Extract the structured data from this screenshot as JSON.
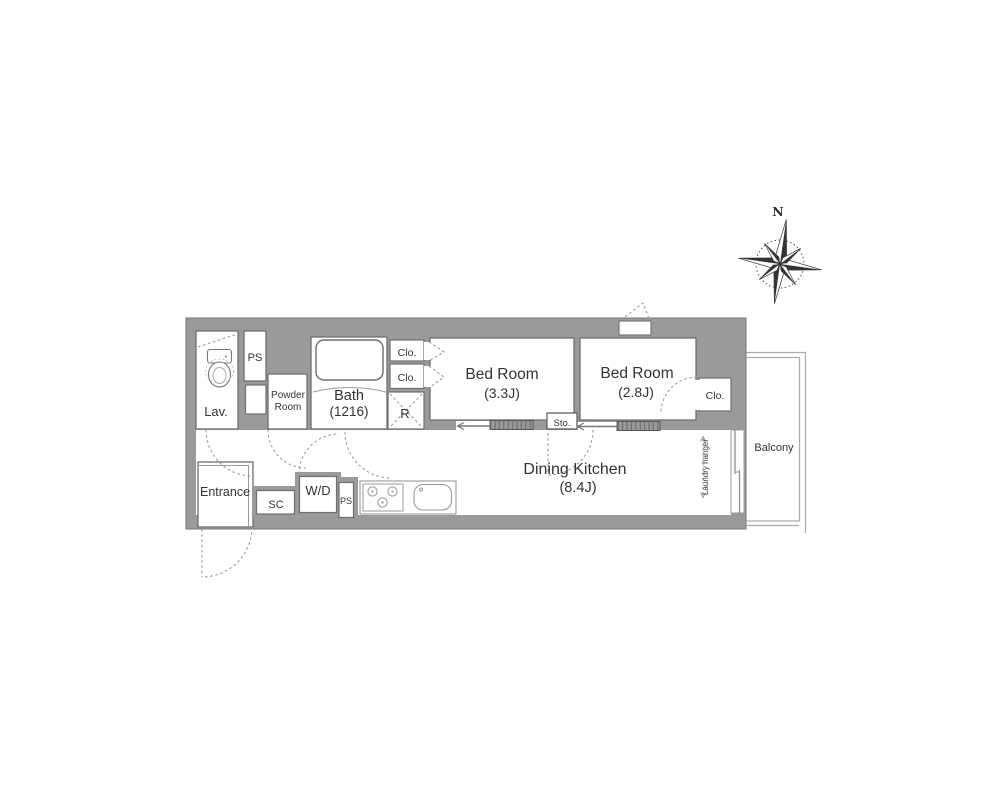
{
  "compass": {
    "north_label": "N"
  },
  "rooms": {
    "lav": {
      "label": "Lav."
    },
    "ps_top": {
      "label": "PS"
    },
    "powder_room": {
      "line1": "Powder",
      "line2": "Room"
    },
    "bath": {
      "name": "Bath",
      "size": "(1216)"
    },
    "closet_a": {
      "label": "Clo."
    },
    "closet_b": {
      "label": "Clo."
    },
    "refrigerator": {
      "label": "R"
    },
    "bedroom_1": {
      "name": "Bed Room",
      "size": "(3.3J)"
    },
    "bedroom_2": {
      "name": "Bed Room",
      "size": "(2.8J)"
    },
    "closet_right": {
      "label": "Clo."
    },
    "storage": {
      "label": "Sto."
    },
    "dining_kitchen": {
      "name": "Dining Kitchen",
      "size": "(8.4J)"
    },
    "entrance": {
      "label": "Entrance"
    },
    "shoe_closet": {
      "label": "SC"
    },
    "washer_dryer": {
      "label": "W/D"
    },
    "ps_bottom": {
      "label": "PS"
    },
    "balcony": {
      "label": "Balcony"
    },
    "laundry_hanger": {
      "label": "Laundry hanger"
    }
  },
  "colors": {
    "wall": "#9a9a9a",
    "room_outline": "#6e6e6e",
    "text": "#333333"
  }
}
